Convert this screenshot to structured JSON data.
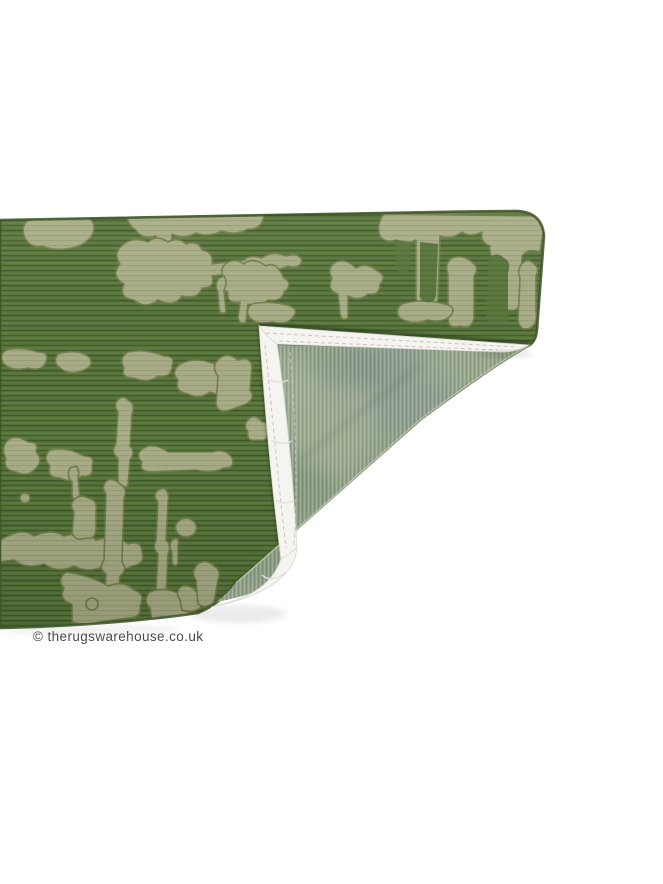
{
  "photo": {
    "alt": "Green textured rug with folded corner showing backing",
    "width": 663,
    "height": 884
  },
  "watermark": {
    "text": "© therugswarehouse.co.uk"
  },
  "colors": {
    "background": "#ffffff",
    "rug_front_green": "#567539",
    "rug_front_dark": "#3c5427",
    "rug_pattern_sage": "#a9ad87",
    "rug_pattern_outline": "#73804b",
    "rug_backing_green": "#92a289",
    "backing_gray_patch": "#8a9a96",
    "binding_white": "#f5f4f0",
    "binding_shadow": "#d9d6d0",
    "stitch": "#c9c5bc",
    "watermark_gray": "#4b4b4b"
  }
}
